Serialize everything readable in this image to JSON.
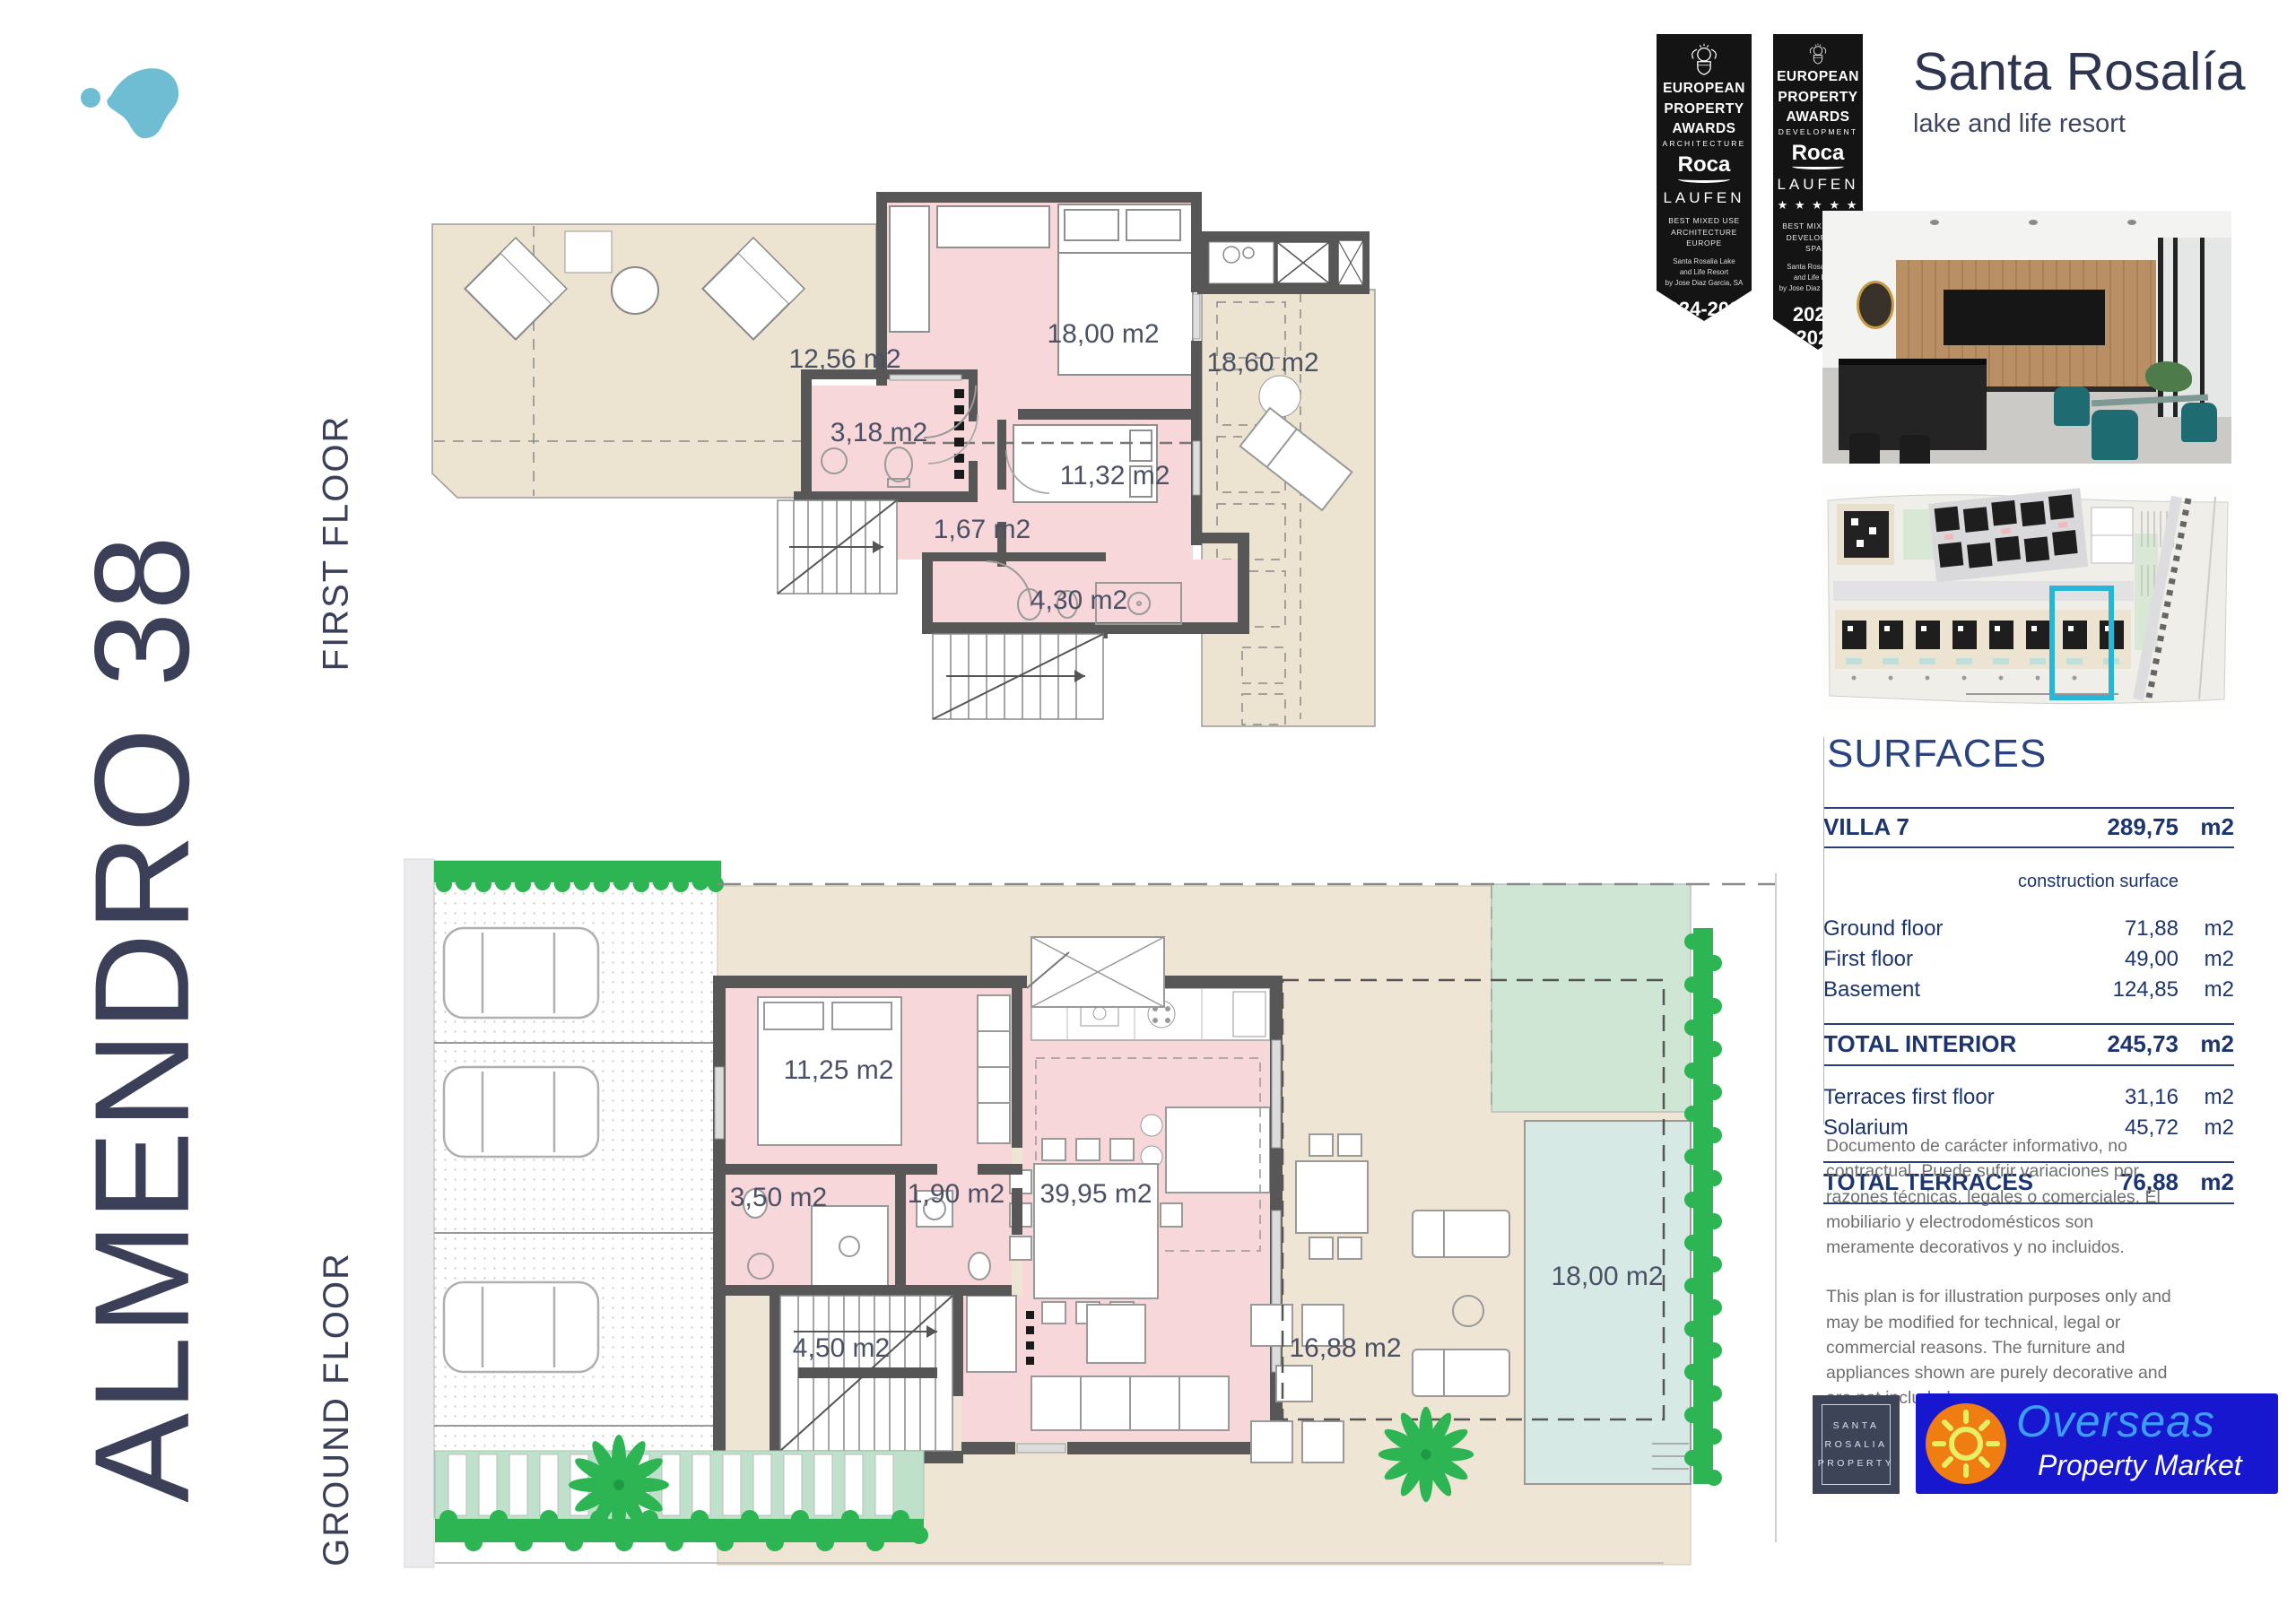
{
  "sidebar": {
    "project_title": "ALMENDRO 38",
    "first_floor_label": "FIRST FLOOR",
    "ground_floor_label": "GROUND FLOOR"
  },
  "brand": {
    "name": "Santa Rosalía",
    "tagline": "lake and life resort"
  },
  "awards": {
    "banners": [
      {
        "org_line1": "EUROPEAN",
        "org_line2": "PROPERTY",
        "org_line3": "AWARDS",
        "category": "ARCHITECTURE",
        "sponsor_roca": "Roca",
        "sponsor_laufen": "LAUFEN",
        "stars": "",
        "award_line1": "BEST MIXED USE",
        "award_line2": "ARCHITECTURE",
        "award_line3": "EUROPE",
        "recipient_line1": "Santa Rosalia Lake",
        "recipient_line2": "and Life Resort",
        "recipient_line3": "by Jose Diaz Garcia, SA",
        "years": "2024-2025"
      },
      {
        "org_line1": "EUROPEAN",
        "org_line2": "PROPERTY",
        "org_line3": "AWARDS",
        "category": "DEVELOPMENT",
        "sponsor_roca": "Roca",
        "sponsor_laufen": "LAUFEN",
        "stars": "★ ★ ★ ★ ★",
        "award_line1": "BEST MIXED USE",
        "award_line2": "DEVELOPMENT",
        "award_line3": "SPAIN",
        "recipient_line1": "Santa Rosalia Lake",
        "recipient_line2": "and Life Resort",
        "recipient_line3": "by Jose Diaz Garcia, SA",
        "years": "2024-2025"
      }
    ]
  },
  "first_floor_plan": {
    "rooms": [
      {
        "label": "12,56 m2"
      },
      {
        "label": "18,00 m2"
      },
      {
        "label": "18,60 m2"
      },
      {
        "label": "3,18 m2"
      },
      {
        "label": "11,32 m2"
      },
      {
        "label": "1,67 m2"
      },
      {
        "label": "4,30 m2"
      }
    ]
  },
  "ground_floor_plan": {
    "rooms": [
      {
        "label": "11,25 m2"
      },
      {
        "label": "3,50 m2"
      },
      {
        "label": "1,90 m2"
      },
      {
        "label": "39,95 m2"
      },
      {
        "label": "4,50 m2"
      },
      {
        "label": "16,88 m2"
      },
      {
        "label": "18,00 m2"
      }
    ]
  },
  "surfaces": {
    "title": "SURFACES",
    "header_row": {
      "label": "VILLA 7",
      "value": "289,75",
      "unit": "m2"
    },
    "column_note": "construction surface",
    "rows": [
      {
        "label": "Ground floor",
        "value": "71,88",
        "unit": "m2"
      },
      {
        "label": "First floor",
        "value": "49,00",
        "unit": "m2"
      },
      {
        "label": "Basement",
        "value": "124,85",
        "unit": "m2"
      }
    ],
    "total_interior": {
      "label": "TOTAL INTERIOR",
      "value": "245,73",
      "unit": "m2"
    },
    "terrace_rows": [
      {
        "label": "Terraces first floor",
        "value": "31,16",
        "unit": "m2"
      },
      {
        "label": "Solarium",
        "value": "45,72",
        "unit": "m2"
      }
    ],
    "total_terraces": {
      "label": "TOTAL TERRACES",
      "value": "76,88",
      "unit": "m2"
    }
  },
  "disclaimer": {
    "spanish": "Documento de carácter informativo, no contractual. Puede sufrir variaciones por razones técnicas, legales o comerciales. El mobiliario y electrodomésticos son meramente decorativos y no incluidos.",
    "english": "This plan is for illustration purposes only and may be modified for technical, legal or commercial reasons. The furniture and appliances shown are purely decorative and are not included."
  },
  "footer": {
    "sr_property": {
      "line1": "SANTA",
      "line2": "ROSALIA",
      "line3": "PROPERTY"
    },
    "overseas": {
      "line1": "Overseas",
      "line2": "Property Market"
    }
  }
}
